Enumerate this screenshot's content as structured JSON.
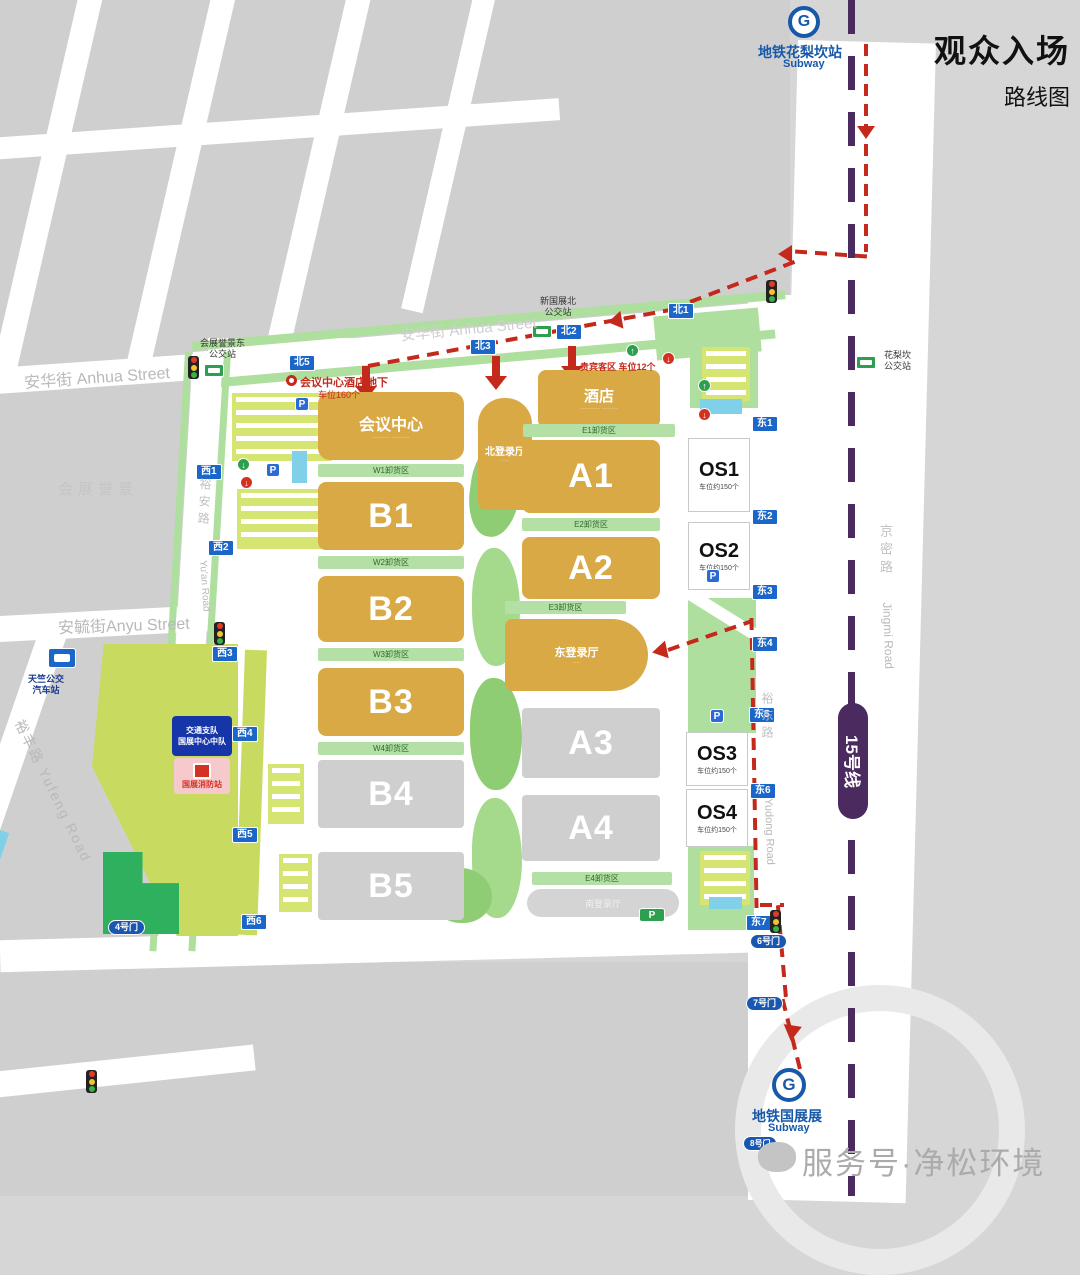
{
  "title": {
    "main": "观众入场",
    "sub": "路线图"
  },
  "metro": {
    "top_station": "地铁花梨坎站",
    "top_en": "Subway",
    "bottom_station": "地铁国展展",
    "bottom_en": "Subway",
    "line_badge": "15号线",
    "logo": "G"
  },
  "watermark": "服务号·净松环境",
  "area_label": "会展誉景",
  "streets": {
    "anhua": "安华街  Anhua Street",
    "anhua_inner": "安华街 Anhua Street",
    "anyu": "安毓街Anyu Street",
    "yufeng": "裕丰路 Yufeng Road",
    "yuan_cn": "裕安路",
    "yuan_en": "Yu'an Road",
    "yudong_cn": "裕东路",
    "yudong_en": "Yudong Road",
    "jingmi_cn": "京密路",
    "jingmi_en": "Jingmi Road"
  },
  "halls": {
    "huiyi": "会议中心",
    "bei": "北登录厅",
    "hotel": "酒店",
    "dong": "东登录厅",
    "nan": "南登录厅",
    "a1": "A1",
    "a2": "A2",
    "a3": "A3",
    "a4": "A4",
    "b1": "B1",
    "b2": "B2",
    "b3": "B3",
    "b4": "B4",
    "b5": "B5"
  },
  "os": {
    "os1": "OS1",
    "os2": "OS2",
    "os3": "OS3",
    "os4": "OS4",
    "cap": "车位约150个"
  },
  "unloading": {
    "w1": "W1卸货区",
    "w2": "W2卸货区",
    "w3": "W3卸货区",
    "w4": "W4卸货区",
    "e1": "E1卸货区",
    "e2": "E2卸货区",
    "e3": "E3卸货区",
    "e4": "E4卸货区"
  },
  "gates": {
    "n1": "北1",
    "n2": "北2",
    "n3": "北3",
    "n5": "北5",
    "w1": "西1",
    "w2": "西2",
    "w3": "西3",
    "w4": "西4",
    "w5": "西5",
    "w6": "西6",
    "e1": "东1",
    "e2": "东2",
    "e3": "东3",
    "e4": "东4",
    "e5": "东5",
    "e6": "东6",
    "e7": "东7",
    "d4": "4号门",
    "d6": "6号门",
    "d7": "7号门",
    "d8": "8号门"
  },
  "bus_stops": {
    "huizhan1": "会展誉景东",
    "huizhan2": "公交站",
    "xin1": "新国展北",
    "xin2": "公交站",
    "hua1": "花梨坎",
    "hua2": "公交站",
    "tian1": "天竺公交",
    "tian2": "汽车站"
  },
  "notes": {
    "hotel_ug": "会议中心酒店地下",
    "hotel_ug_cap": "车位160个",
    "vip": "贵宾客区 车位12个",
    "p": "P"
  },
  "facilities": {
    "traffic1": "交通支队",
    "traffic2": "国展中心中队",
    "fire": "国展消防站"
  },
  "colors": {
    "route_red": "#c42a1c",
    "metro_purple": "#4b2b5f",
    "hall_gold": "#d9a945",
    "badge_blue": "#1b66c9",
    "strip_green": "#b4e0a6",
    "field_green": "#c8da60"
  }
}
